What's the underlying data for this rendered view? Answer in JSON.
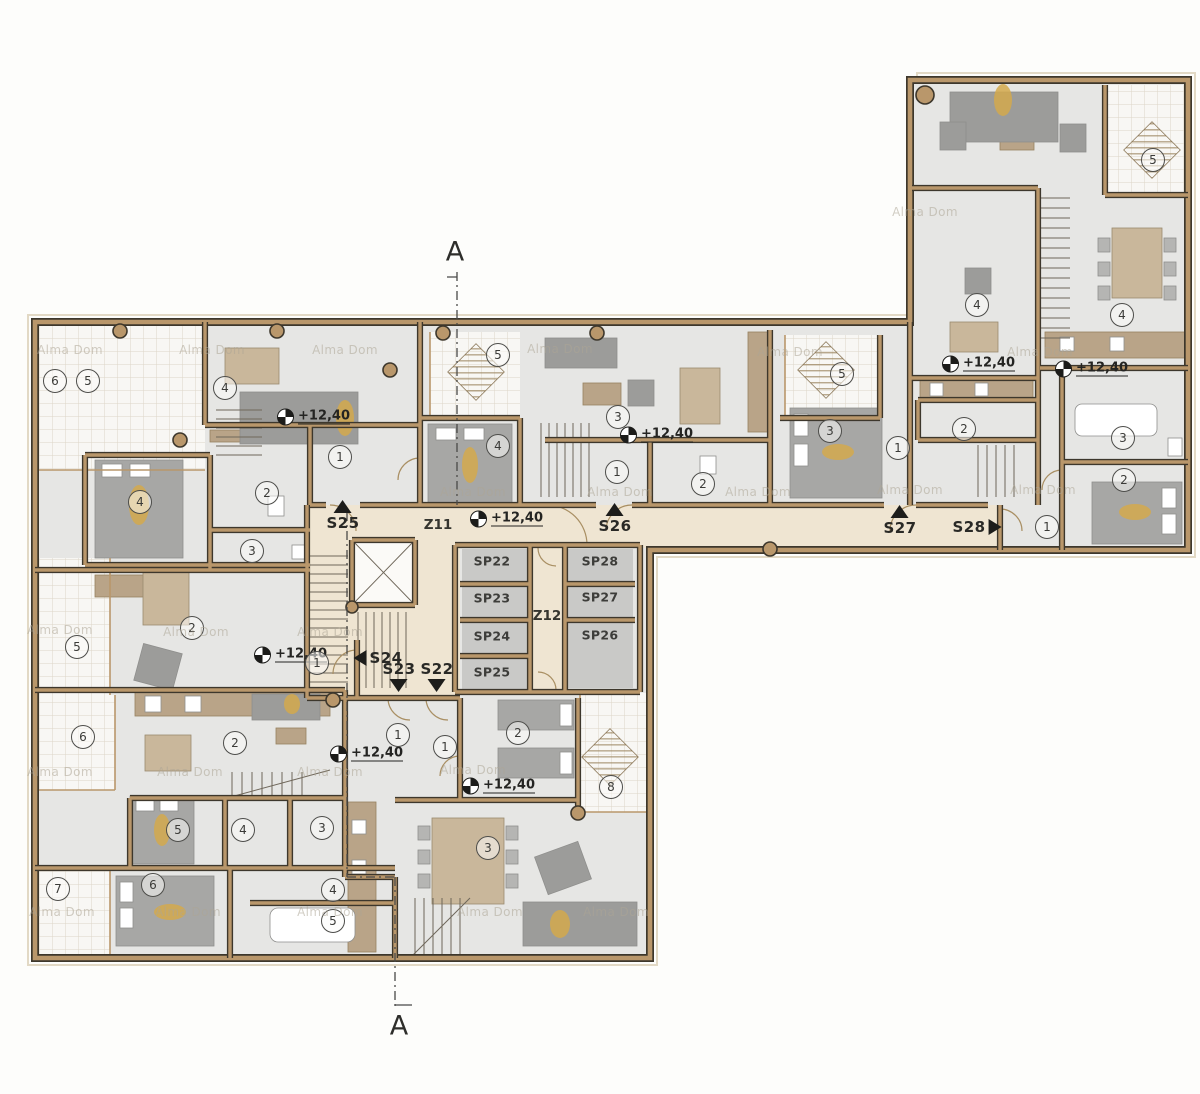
{
  "watermark": {
    "text": "Alma Dom"
  },
  "section": {
    "top": "A",
    "bottom": "A"
  },
  "elevation": {
    "value": "+12,40"
  },
  "cores": {
    "z11": "Z11",
    "z12": "Z12"
  },
  "entrances": [
    {
      "label": "S25",
      "dir": "up"
    },
    {
      "label": "S26",
      "dir": "up"
    },
    {
      "label": "S27",
      "dir": "up"
    },
    {
      "label": "S28",
      "dir": "right"
    },
    {
      "label": "S24",
      "dir": "left"
    },
    {
      "label": "S23",
      "dir": "down"
    },
    {
      "label": "S22",
      "dir": "down"
    }
  ],
  "storage": [
    {
      "label": "SP22"
    },
    {
      "label": "SP23"
    },
    {
      "label": "SP24"
    },
    {
      "label": "SP25"
    },
    {
      "label": "SP26"
    },
    {
      "label": "SP27"
    },
    {
      "label": "SP28"
    }
  ],
  "rooms": [
    "6",
    "5",
    "4",
    "1",
    "2",
    "4",
    "3",
    "2",
    "5",
    "1",
    "5",
    "3",
    "4",
    "1",
    "2",
    "5",
    "3",
    "1",
    "2",
    "5",
    "4",
    "4",
    "3",
    "2",
    "1",
    "6",
    "2",
    "1",
    "5",
    "4",
    "3",
    "7",
    "6",
    "4",
    "5",
    "1",
    "2",
    "8",
    "3"
  ],
  "colors": {
    "wall_fill": "#b9976b",
    "wall_outline": "#3d372c",
    "room_fill": "#e6e6e4",
    "corridor_fill": "#efe5d2",
    "storage_cell_fill": "#c9c9c7",
    "terrace_fill": "#f8f7f4",
    "furniture_gray": "#a7a7a5",
    "furniture_wood": "#c9b79b",
    "accent_gold": "#d3a94c",
    "label_color": "#3b3b38"
  }
}
